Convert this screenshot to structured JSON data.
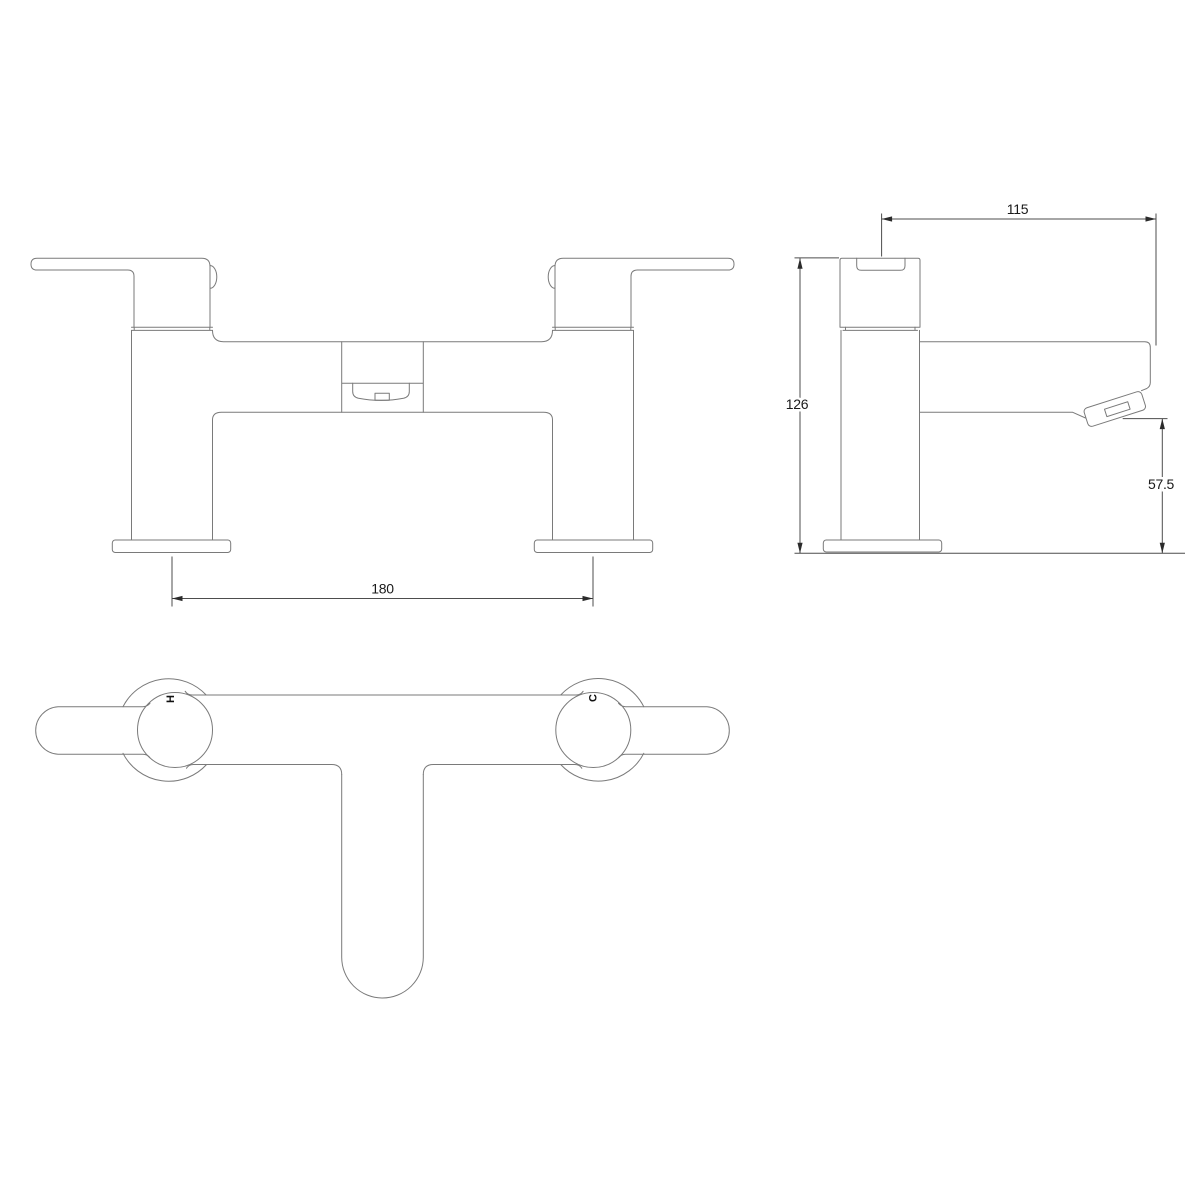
{
  "drawing": {
    "type": "technical-orthographic-drawing",
    "subject": "bath filler tap",
    "colors": {
      "background": "#ffffff",
      "outline": "#7a7a7a",
      "dimension_line": "#4d4d4d",
      "dimension_text": "#1a1a1a"
    },
    "views": {
      "front": {
        "name": "front elevation",
        "dim_leg_centres": {
          "value": "180"
        }
      },
      "side": {
        "name": "side elevation",
        "dim_spout_projection": {
          "value": "115"
        },
        "dim_overall_height": {
          "value": "126"
        },
        "dim_spout_outlet_height": {
          "value": "57.5"
        }
      },
      "plan": {
        "name": "plan view",
        "hot_label": "H",
        "cold_label": "C"
      }
    }
  }
}
